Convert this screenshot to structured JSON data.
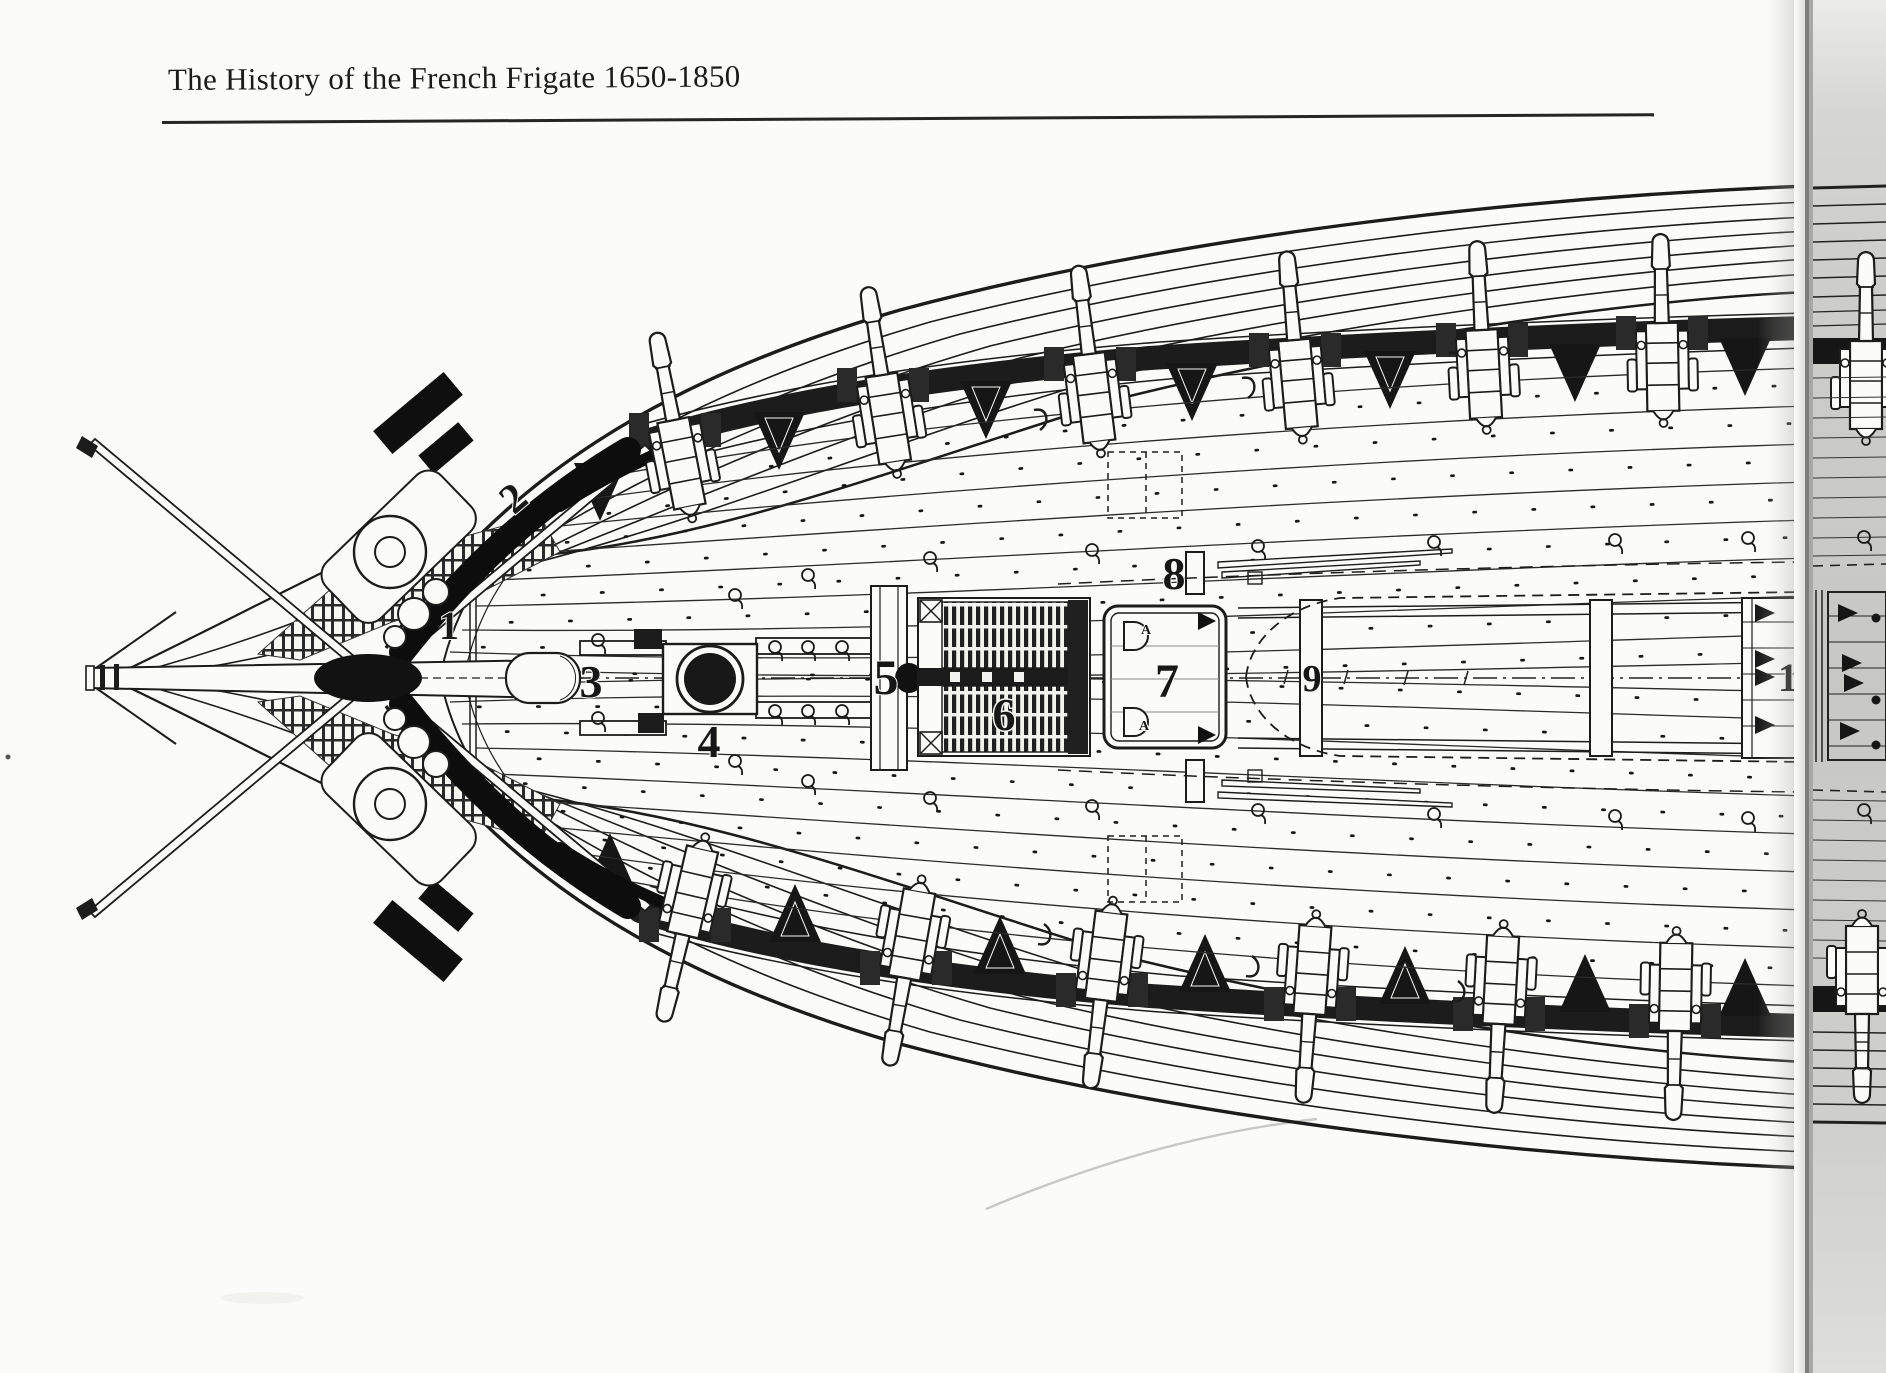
{
  "header": {
    "title": "The History of the French Frigate 1650-1850"
  },
  "diagram": {
    "labels": [
      {
        "text": "1"
      },
      {
        "text": "2"
      },
      {
        "text": "3"
      },
      {
        "text": "4"
      },
      {
        "text": "5"
      },
      {
        "text": "6"
      },
      {
        "text": "7"
      },
      {
        "text": "8"
      },
      {
        "text": "9"
      },
      {
        "text": "10"
      }
    ],
    "hatch_letters": [
      "A",
      "A"
    ],
    "colors": {
      "ink": "#1c1c1c",
      "paper": "#fbfbf9",
      "facing_page_gray": "#c9c9c7",
      "gutter_shadow": "#7d7d7b"
    }
  }
}
